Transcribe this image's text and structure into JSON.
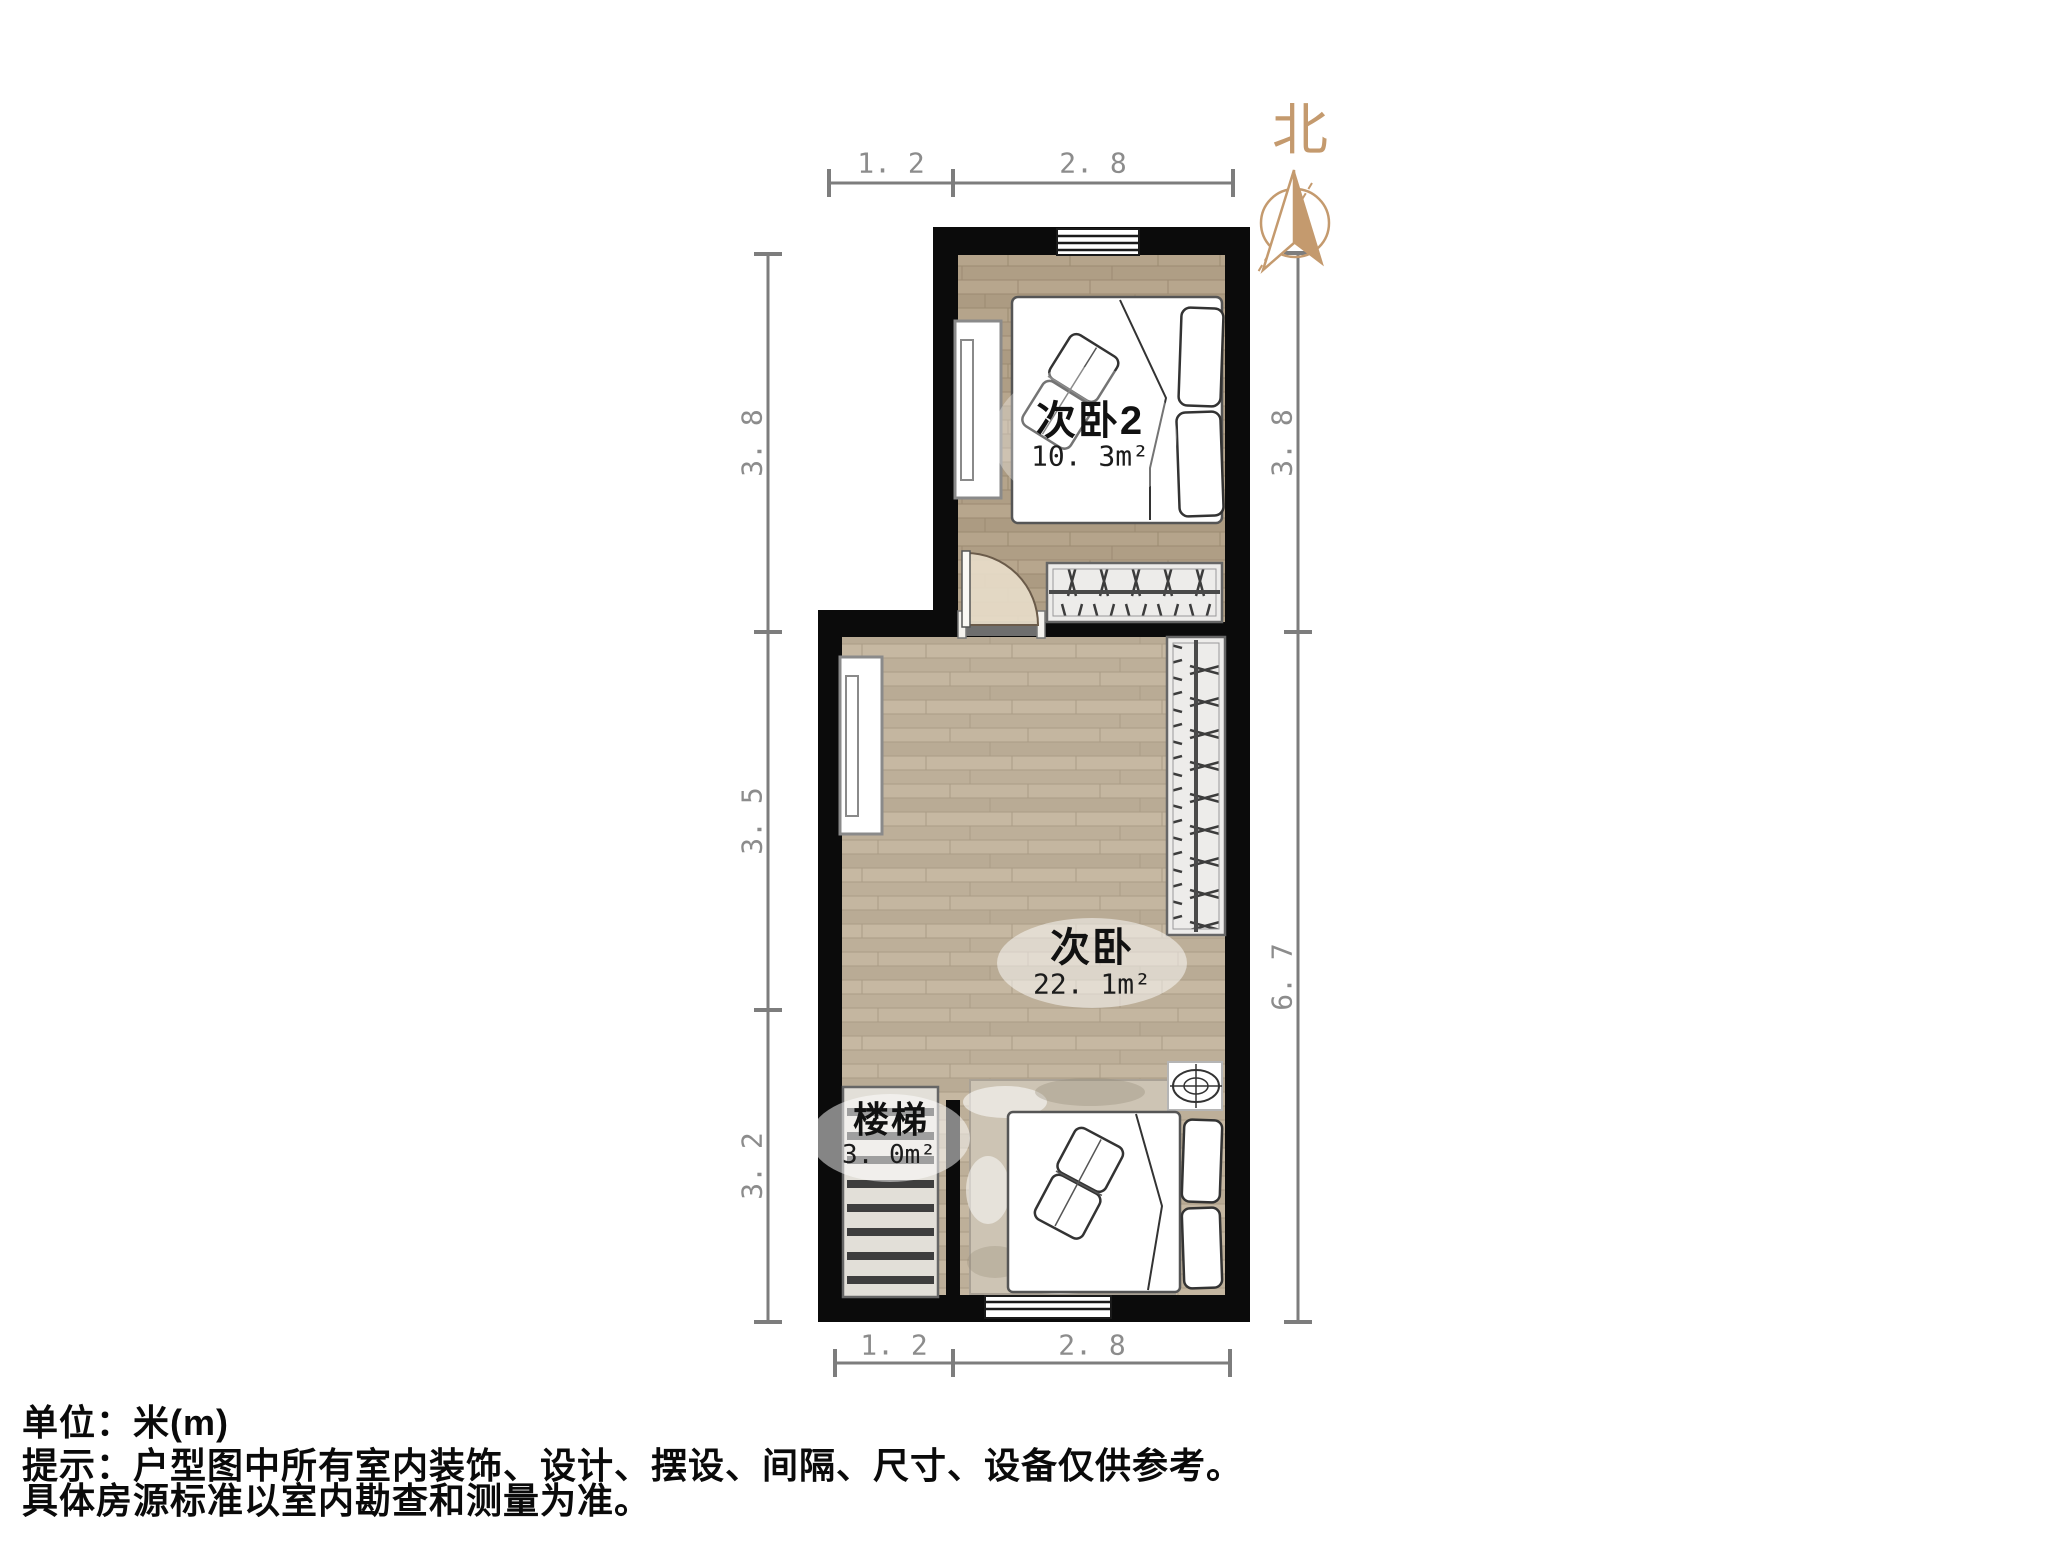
{
  "compass": {
    "north_label": "北"
  },
  "dimensions": {
    "top": [
      "1. 2",
      "2. 8"
    ],
    "bottom": [
      "1. 2",
      "2. 8"
    ],
    "left": [
      "3. 8",
      "3. 5",
      "3. 2"
    ],
    "right": [
      "3. 8",
      "6. 7"
    ]
  },
  "rooms": [
    {
      "name": "次卧2",
      "area": "10. 3m²"
    },
    {
      "name": "次卧",
      "area": "22. 1m²"
    },
    {
      "name": "楼梯",
      "area": "3. 0m²"
    }
  ],
  "footer": {
    "line1": "单位：米(m)",
    "line2": "提示：户型图中所有室内装饰、设计、摆设、间隔、尺寸、设备仅供参考。",
    "line3": "具体房源标准以室内勘查和测量为准。"
  },
  "colors": {
    "wall": "#0b0b0b",
    "floor_dark": "#b1a087",
    "floor_light": "#c0b29c",
    "compass": "#c49a6e",
    "dimension": "#8c8c8c",
    "label_text": "#111111"
  }
}
